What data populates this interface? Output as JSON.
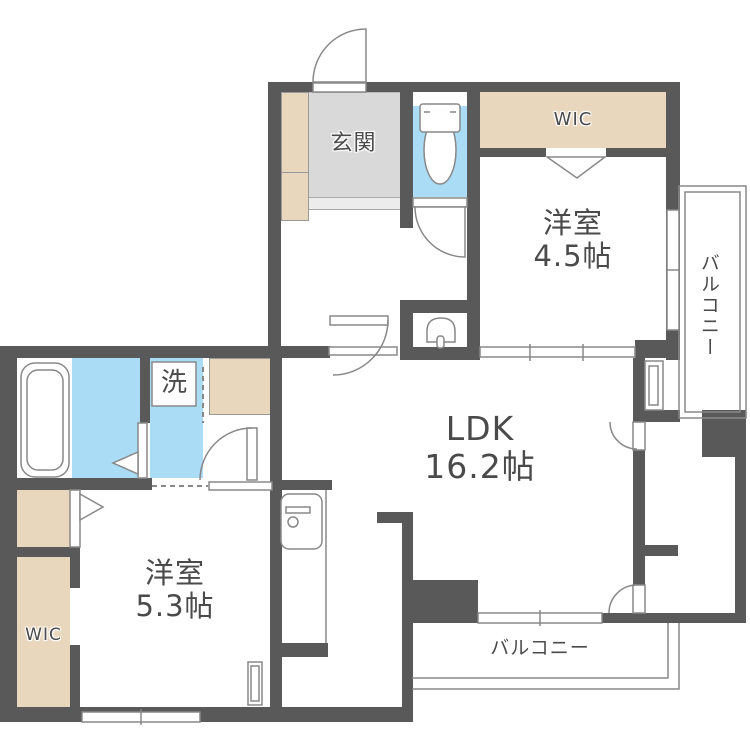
{
  "title": "apartment-floor-plan",
  "rooms": {
    "genkan": {
      "label": "玄関"
    },
    "wic_top": {
      "label": "WIC"
    },
    "bedroom1": {
      "name": "洋室",
      "size": "4.5帖"
    },
    "balcony_right": {
      "label": "バルコニー"
    },
    "ldk": {
      "name": "LDK",
      "size": "16.2帖"
    },
    "washer": {
      "label": "洗"
    },
    "bedroom2": {
      "name": "洋室",
      "size": "5.3帖"
    },
    "wic_bottom": {
      "label": "WIC"
    },
    "balcony_bottom": {
      "label": "バルコニー"
    }
  },
  "colors": {
    "wall": "#595959",
    "accent-beige": "#e9d7bd",
    "accent-blue": "#aadcf5",
    "tile-gray": "#d9d9d9",
    "step-gray": "#ececec",
    "line-gray": "#888888",
    "text-gray": "#4a4a4a"
  }
}
